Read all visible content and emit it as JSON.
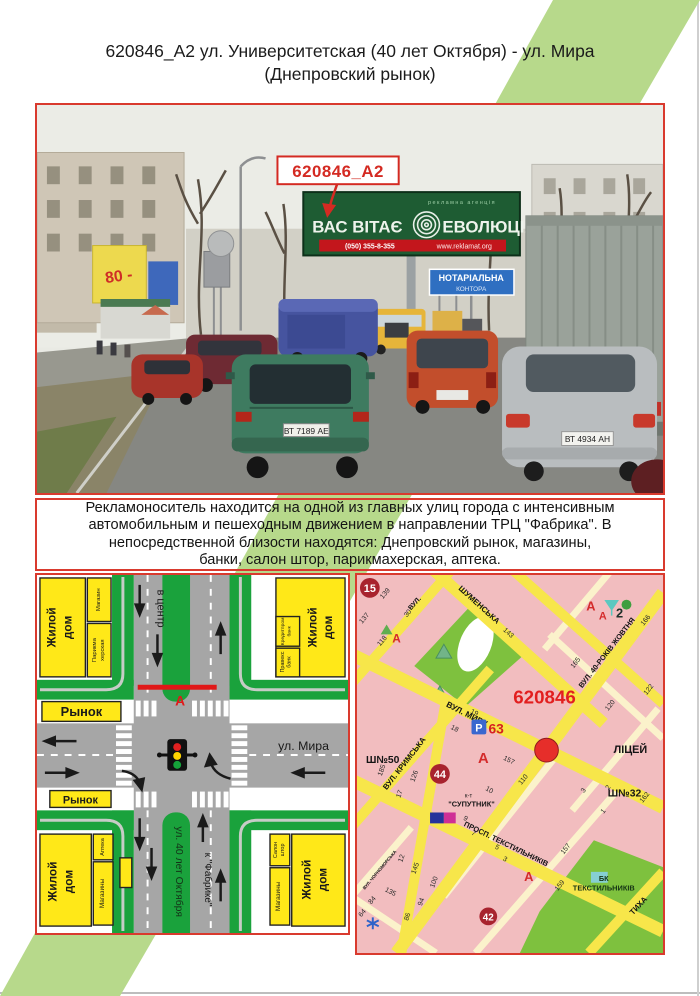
{
  "page": {
    "title_line1": "620846_A2 ул. Университетская (40 лет Октября) - ул. Мира",
    "title_line2": "(Днепровский рынок)",
    "accent_green": "#b7d98b",
    "border_red": "#d93a2e"
  },
  "photo": {
    "callout": "620846_A2",
    "billboard": {
      "tagline": "рекламна агенція",
      "left": "ВАС ВІТАЄ",
      "right": "ЕВОЛЮЦІЯ",
      "phone": "(050) 355-8-355",
      "site": "www.reklamat.org"
    },
    "sign": {
      "l1": "НОТАРІАЛЬНА",
      "l2": "КОНТОРА"
    },
    "shop_sign": "80 -",
    "plate_green": "ВТ 7189 АЕ",
    "plate_silver": "ВТ 4934 АН"
  },
  "description": {
    "l1": "Рекламоноситель находится на одной из главных улиц города с интенсивным",
    "l2": "автомобильным и пешеходным движением в направлении ТРЦ \"Фабрика\". В",
    "l3": "непосредственной близости находятся: Днепровский рынок, магазины,",
    "l4": "банки, салон штор, парикмахерская, аптека."
  },
  "scheme": {
    "res_l1": "Жилой",
    "res_l2": "дом",
    "market": "Рынок",
    "shop": "Магазин",
    "hair1": "Парикма",
    "hair2": "херская",
    "bank_k": "Кредитпром",
    "bank_word": "банк",
    "bank_p": "Правекс",
    "pharmacy": "Аптека",
    "shops": "Магазины",
    "curt1": "Салон",
    "curt2": "штор",
    "to_center": "в центр",
    "mira": "ул. Мира",
    "october": "ул. 40 лет Октября",
    "fabrika": "к \"Фабрике\"",
    "marker": "А"
  },
  "map": {
    "id": "620846",
    "streets": [
      "ШУМЕНСЬКА",
      "ВУЛ. МИРУ",
      "ВУЛ. КРИМСЬКА",
      "ВУЛ. 40-РОКІВ ЖОВТНЯ",
      "ПРОСП. ТЕКСТИЛЬНИКІВ",
      "ВУЛ. ЧОРНОМОРСЬКА",
      "ТИХА",
      "ВУЛ."
    ],
    "numbers": [
      "139",
      "137",
      "30",
      "118",
      "143",
      "165",
      "166",
      "122",
      "120",
      "19",
      "18",
      "157",
      "110",
      "185",
      "126",
      "17",
      "12",
      "145",
      "100",
      "94",
      "86",
      "84",
      "64",
      "135",
      "10",
      "9",
      "7",
      "5",
      "3",
      "3",
      "2",
      "1",
      "162",
      "157",
      "159"
    ],
    "pois": {
      "school50": "Ш№50",
      "school32": "Ш№32",
      "lyceum": "ЛІЦЕЙ",
      "cin1": "к-т",
      "cin2": "\"СУПУТНИК\"",
      "bk1": "БК",
      "bk2": "ТЕКСТИЛЬНИКІВ",
      "c15": "15",
      "c44": "44",
      "c42": "42",
      "p": "Р",
      "p63": "63",
      "ph": "А",
      "two": "2"
    }
  }
}
